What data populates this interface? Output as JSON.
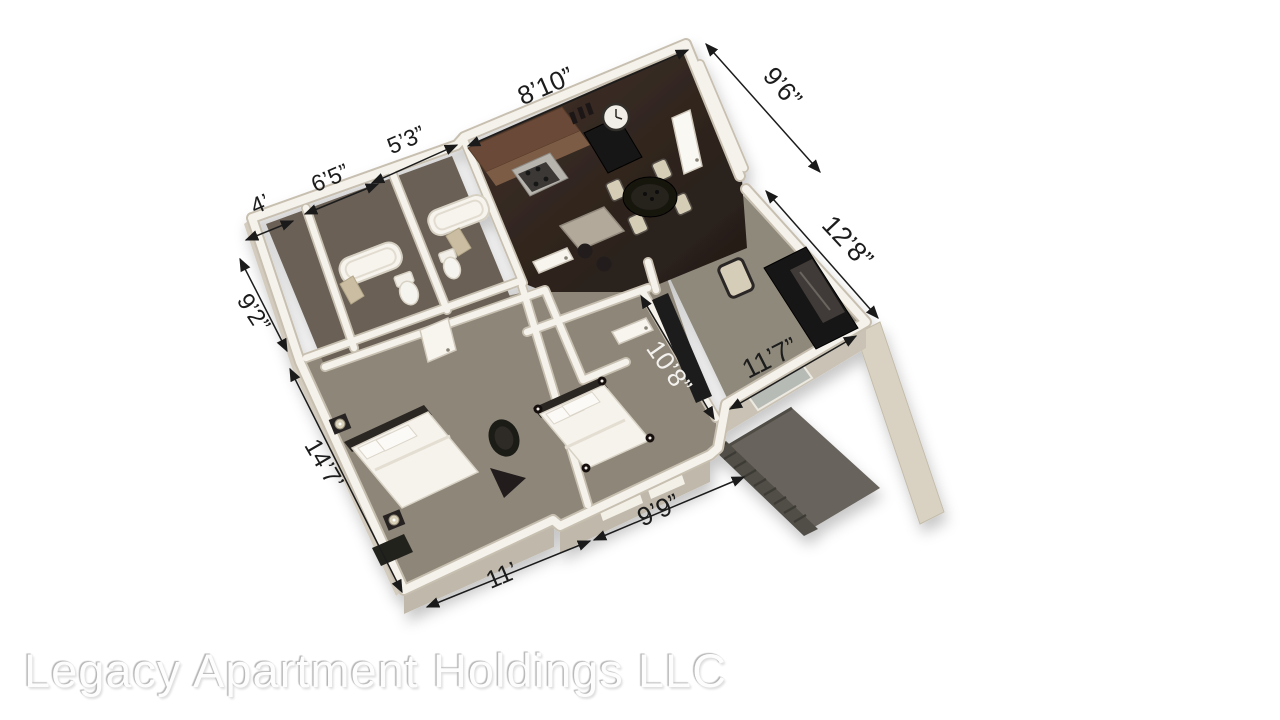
{
  "watermark": {
    "text": "Legacy Apartment Holdings LLC"
  },
  "floorplan": {
    "dimensions": [
      {
        "id": "kitchen-dining-top",
        "label": "8’10”"
      },
      {
        "id": "entry-east",
        "label": "9’6”"
      },
      {
        "id": "bath-right-top",
        "label": "5’3”"
      },
      {
        "id": "bath-left-top",
        "label": "6’5”"
      },
      {
        "id": "linen-top",
        "label": "4’"
      },
      {
        "id": "bath-west",
        "label": "9’2”"
      },
      {
        "id": "bedroom1-west",
        "label": "14’7’"
      },
      {
        "id": "bedroom1-south",
        "label": "11’"
      },
      {
        "id": "living-east",
        "label": "12’8”"
      },
      {
        "id": "living-south",
        "label": "11’7”"
      },
      {
        "id": "bedroom2-east",
        "label": "10’8”"
      },
      {
        "id": "bedroom2-south",
        "label": "9’9”"
      }
    ],
    "colors": {
      "background": "#ffffff",
      "wall": "#f5f2eb",
      "wall_edge": "#c7bfb0",
      "wood_floor": "#3a2d25",
      "carpet": "#8d8679",
      "living_carpet": "#8f897c",
      "bath_tile": "#6a6157",
      "patio": "#67635b",
      "railing": "#514e46",
      "cabinet_brown": "#6b4a37",
      "furniture_dark": "#191615",
      "bedding_white": "#f6f3ec",
      "dimension_text": "#1c1c1c",
      "watermark_text": "#fdfdfd"
    }
  }
}
